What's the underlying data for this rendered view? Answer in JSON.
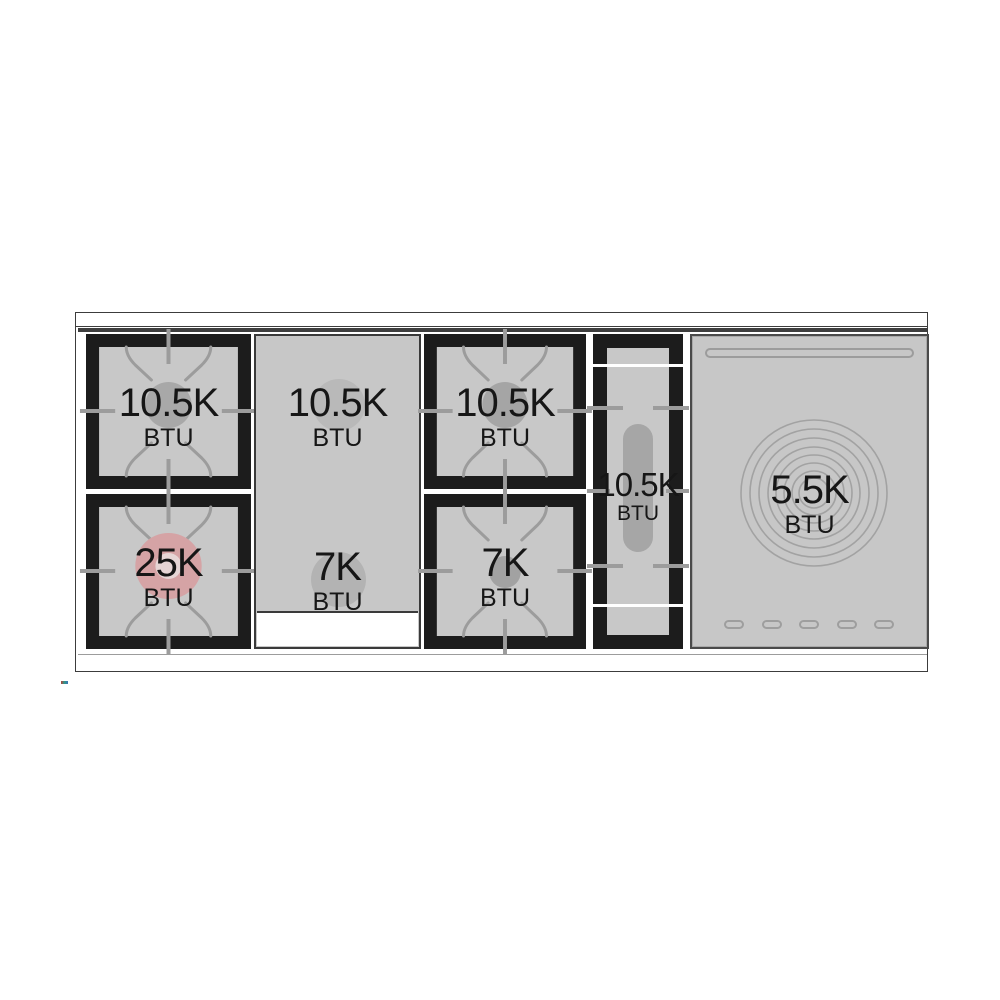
{
  "diagram": {
    "name": "range-cooktop-top-view",
    "colors": {
      "cooktop_gray": "#c7c7c7",
      "frame_black": "#1c1c1c",
      "grate_line": "#9c9c9c",
      "burner_circle_gray": "#a8a8a8",
      "high_btu_pink": "#d5a3a5",
      "outline": "#3c3c3c"
    },
    "burners": {
      "left_rear": {
        "value": "10.5K",
        "unit": "BTU"
      },
      "left_front": {
        "value": "25K",
        "unit": "BTU"
      },
      "griddle_rear": {
        "value": "10.5K",
        "unit": "BTU"
      },
      "griddle_front": {
        "value": "7K",
        "unit": "BTU"
      },
      "center_rear": {
        "value": "10.5K",
        "unit": "BTU"
      },
      "center_front": {
        "value": "7K",
        "unit": "BTU"
      },
      "oval_center": {
        "value": "10.5K",
        "unit": "BTU"
      },
      "simmer_right": {
        "value": "5.5K",
        "unit": "BTU"
      }
    }
  }
}
